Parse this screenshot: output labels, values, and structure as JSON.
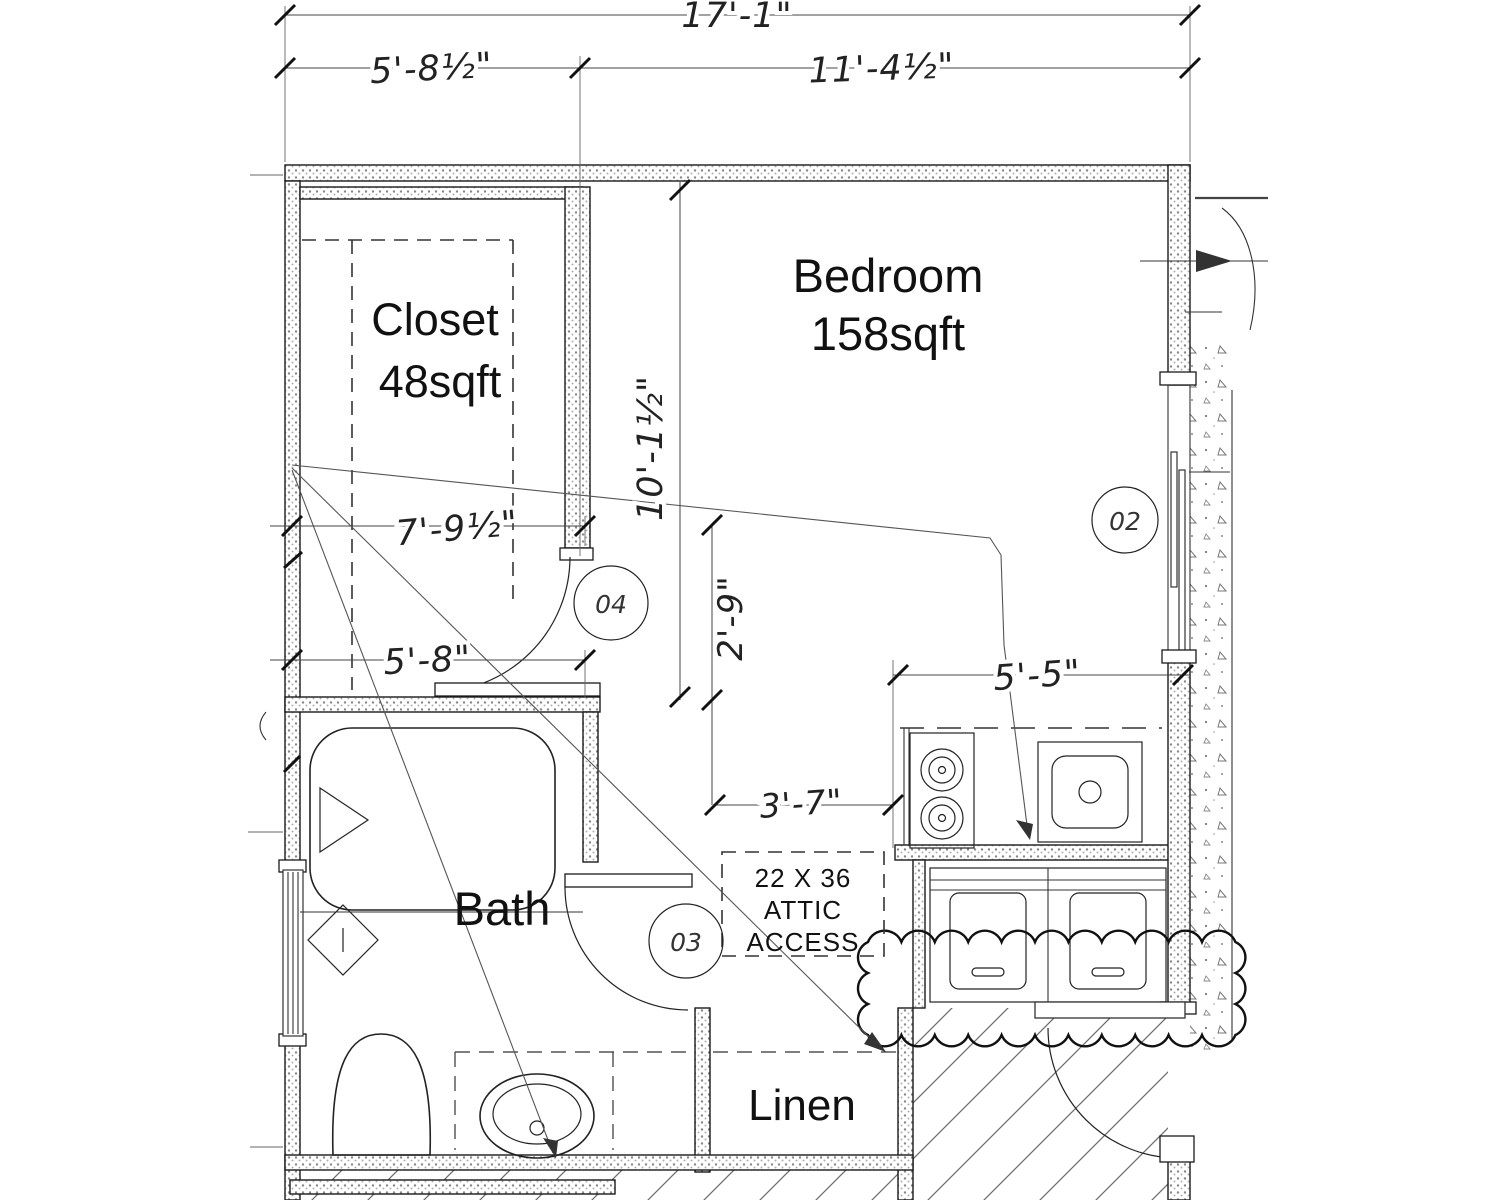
{
  "plan": {
    "rooms": {
      "closet": {
        "name": "Closet",
        "area": "48sqft"
      },
      "bedroom": {
        "name": "Bedroom",
        "area": "158sqft"
      },
      "bath": {
        "name": "Bath"
      },
      "linen": {
        "name": "Linen"
      }
    },
    "dimensions": {
      "overall_width": "17'-1\"",
      "closet_width": "5'-8½\"",
      "bedroom_width": "11'-4½\"",
      "bedroom_depth": "10'-1½\"",
      "closet_front": "7'-9½\"",
      "bath_width": "5'-8\"",
      "hall_width": "2'-9\"",
      "attic_span": "3'-7\"",
      "counter_span": "5'-5\""
    },
    "attic_access": {
      "line1": "22 X 36",
      "line2": "ATTIC",
      "line3": "ACCESS"
    },
    "door_tags": {
      "bedroom_window": "02",
      "closet_door": "04",
      "bath_door": "03"
    },
    "colors": {
      "line": "#1a1a1a",
      "dim": "#333333",
      "hatch": "#6e6e6e",
      "wall_dot": "#8a8a8a"
    }
  }
}
